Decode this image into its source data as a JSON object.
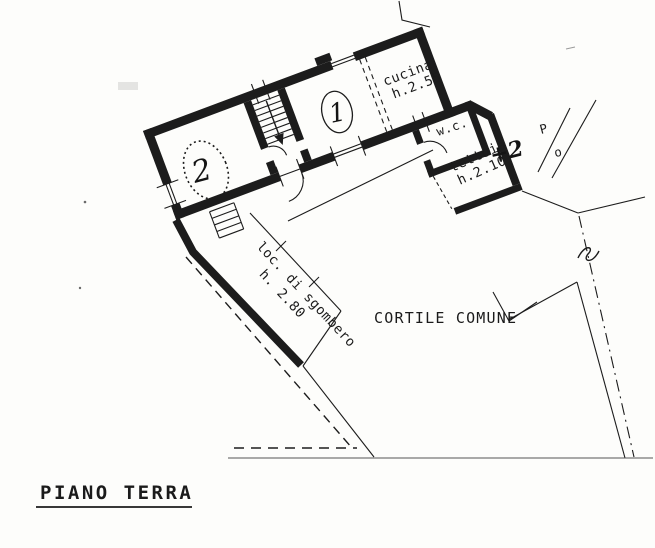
{
  "colors": {
    "paper": "#fdfdfb",
    "ink": "#1c1c1c",
    "faint_line": "#555555"
  },
  "plan": {
    "title": "PIANO TERRA",
    "rooms": {
      "room1": {
        "number": "1"
      },
      "room2": {
        "number": "2"
      },
      "cucina": {
        "label": "cucina",
        "height": "h.2.55"
      },
      "wc": {
        "label": "w.c."
      },
      "tettoia": {
        "label": "tettoia",
        "height": "h.2.10",
        "annotation": "+2"
      },
      "sgombero": {
        "label": "loc. di sgombero",
        "height": "h. 2.80"
      }
    },
    "courtyard": {
      "label": "CORTILE COMUNE"
    },
    "marks": {
      "p": "P",
      "o": "o"
    }
  }
}
